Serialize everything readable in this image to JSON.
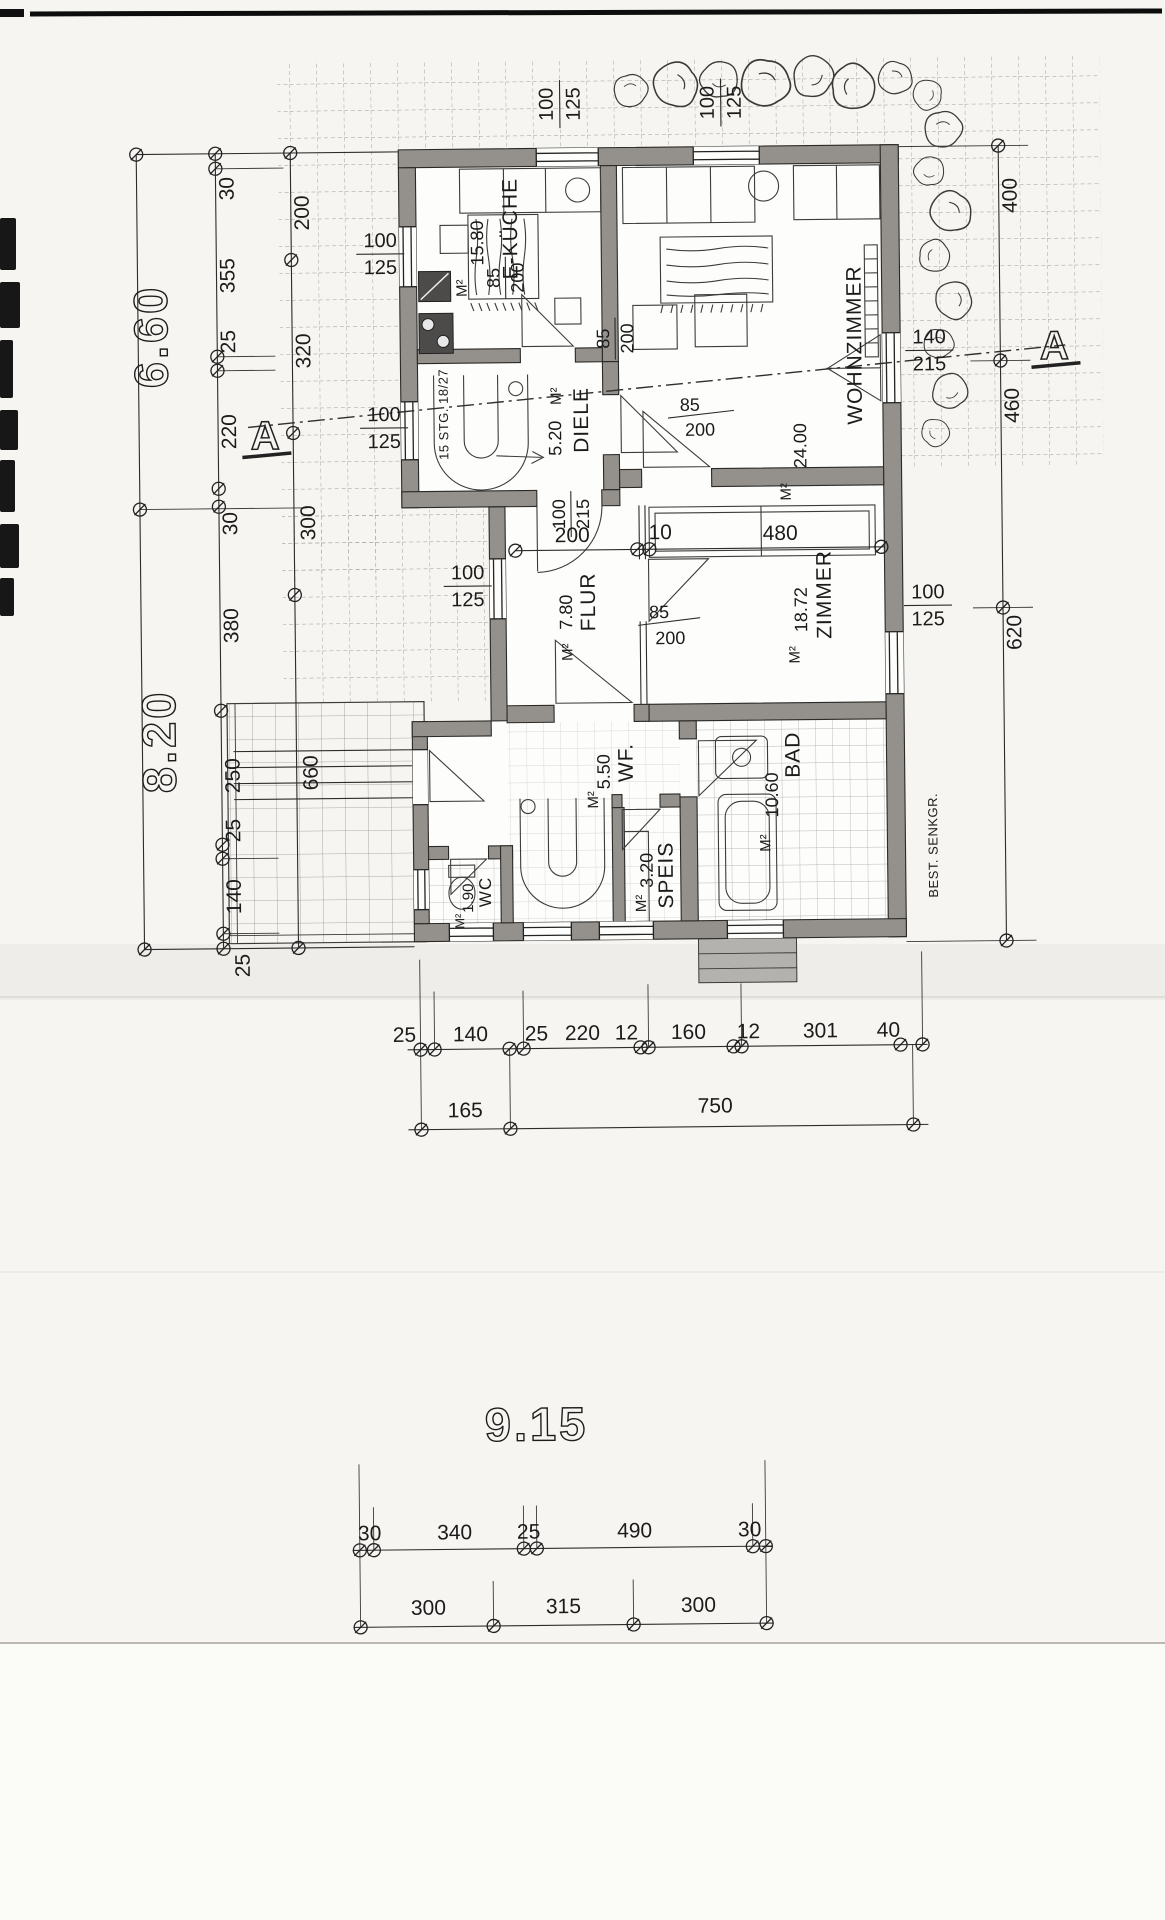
{
  "plan": {
    "rooms": {
      "kueche": {
        "name": "E-KÜCHE",
        "area": "15.80",
        "unit": "M²"
      },
      "wohnzimmer": {
        "name": "WOHNZIMMER",
        "area": "24.00",
        "unit": "M²"
      },
      "diele": {
        "name": "DIELE",
        "area": "5.20",
        "unit": "M²"
      },
      "zimmer": {
        "name": "ZIMMER",
        "area": "18.72",
        "unit": "M²"
      },
      "flur": {
        "name": "FLUR",
        "area": "7.80",
        "unit": "M²"
      },
      "wf": {
        "name": "WF.",
        "area": "5.50",
        "unit": "M²"
      },
      "bad": {
        "name": "BAD",
        "area": "10.60",
        "unit": "M²"
      },
      "speis": {
        "name": "SPEIS",
        "area": "3.20",
        "unit": "M²"
      },
      "wc": {
        "name": "WC",
        "area": "1.90",
        "unit": "M²"
      }
    },
    "notes": {
      "stairs": "15 STG. 18/27",
      "cesspit": "BEST. SENKGR.",
      "section_left": "A",
      "section_right": "A"
    },
    "openings": {
      "top_window_kueche": {
        "w": "100",
        "h": "125"
      },
      "top_window_wohnzimmer": {
        "w": "100",
        "h": "125"
      },
      "west_window_kueche": {
        "w": "100",
        "h": "125"
      },
      "west_window_diele": {
        "w": "100",
        "h": "125"
      },
      "west_window_flur": {
        "w": "100",
        "h": "125"
      },
      "east_door_wohnzimmer": {
        "w": "140",
        "h": "215"
      },
      "east_window_zimmer": {
        "w": "100",
        "h": "125"
      },
      "door_kueche": {
        "w": "85",
        "h": "200"
      },
      "door_wohnzimmer": {
        "w": "85",
        "h": "200"
      },
      "door_zimmer": {
        "w": "85",
        "h": "200"
      },
      "door_flur": {
        "w": "85",
        "h": "200"
      },
      "door_diele_flur": {
        "w": "100",
        "h": "215"
      }
    },
    "dimensions": {
      "left_total_upper": "6.60",
      "left_total_lower": "8.20",
      "left_chain": [
        "30",
        "355",
        "25",
        "220",
        "30",
        "380",
        "250",
        "25",
        "140",
        "25"
      ],
      "left_room_chain": [
        "200",
        "320",
        "300",
        "660"
      ],
      "right_chain": [
        "400",
        "460",
        "620"
      ],
      "interior_chain": [
        "200",
        "10",
        "480"
      ],
      "bottom_chain": [
        "25",
        "140",
        "25",
        "220",
        "12",
        "160",
        "12",
        "301",
        "40"
      ],
      "bottom_totals": [
        "165",
        "750"
      ],
      "site_total": "9.15",
      "site_chain": [
        "30",
        "340",
        "25",
        "490",
        "30"
      ],
      "site_totals": [
        "300",
        "315",
        "300"
      ]
    }
  }
}
